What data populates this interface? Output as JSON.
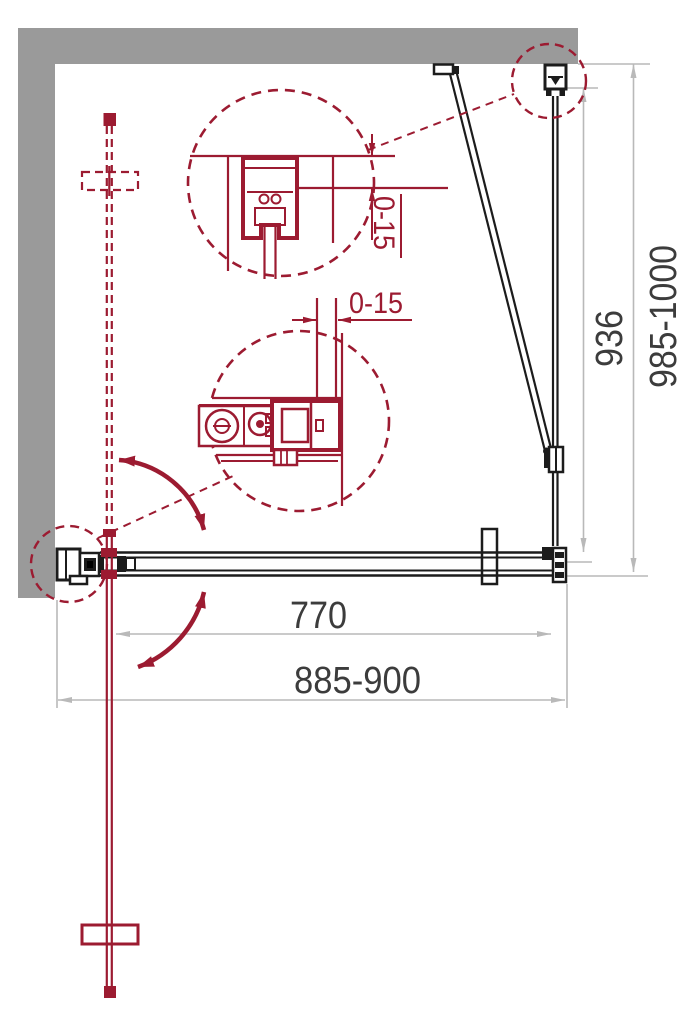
{
  "dimensions": {
    "total_width": "885-900",
    "door_opening_width": "770",
    "side_panel_width": "936",
    "total_depth": "985-1000",
    "wall_profile_adjustment_top": "0-15",
    "wall_profile_adjustment_side": "0-15"
  },
  "colors": {
    "wall_gray": "#9a9a9a",
    "accent_red": "#9c1b31",
    "dimension_line_gray": "#b9b9b9",
    "dimension_text": "#3c3c3c",
    "structure_black": "#1c1c1c",
    "background": "#ffffff"
  }
}
